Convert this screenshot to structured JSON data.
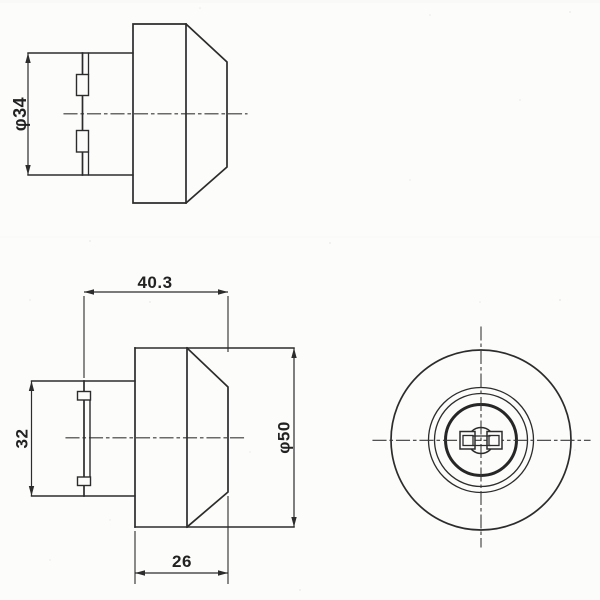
{
  "drawing": {
    "background_color": "#fcfcfb",
    "line_color": "#2c2c2c",
    "dimensions": {
      "body_diameter": "φ34",
      "overall_length": "40.3",
      "body_width_across_flats": "32",
      "head_diameter": "φ50",
      "head_length": "26"
    }
  }
}
